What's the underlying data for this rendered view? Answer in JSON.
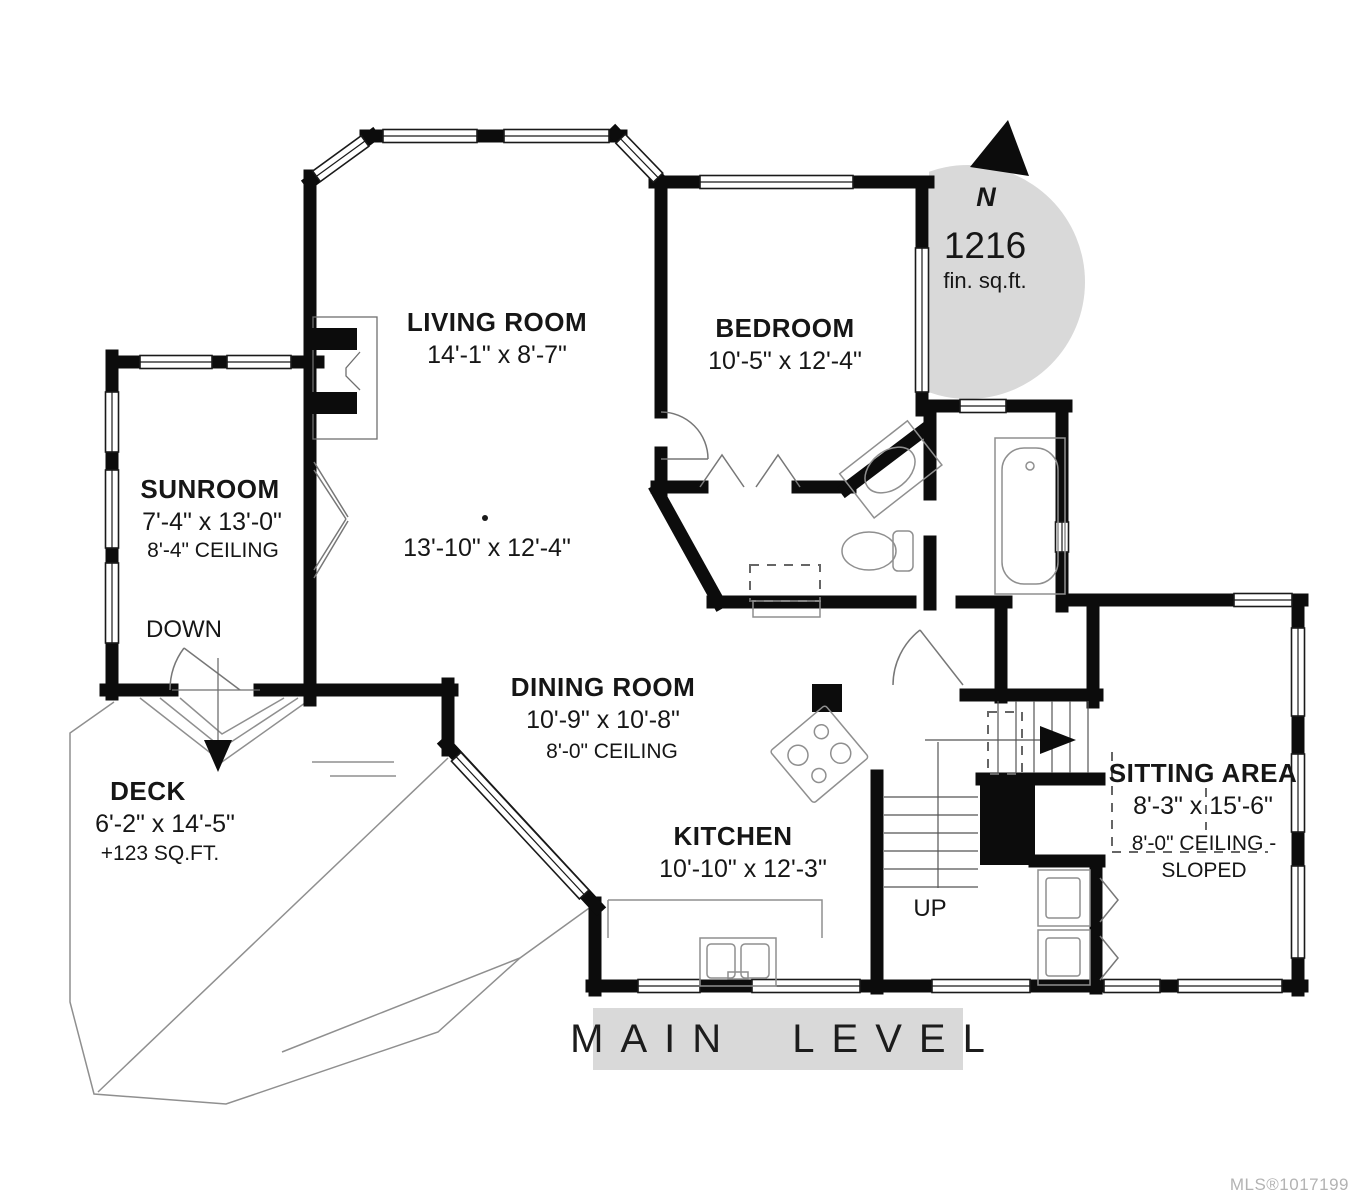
{
  "banner": {
    "label": "MAIN LEVEL"
  },
  "footer": {
    "mls": "MLS®1017199"
  },
  "compass": {
    "north_label": "N",
    "area_value": "1216",
    "area_unit": "fin. sq.ft."
  },
  "rooms": {
    "living_room": {
      "name": "LIVING ROOM",
      "dims": "14'-1\" x 8'-7\""
    },
    "living_room_lower": {
      "dims": "13'-10\" x 12'-4\""
    },
    "bedroom": {
      "name": "BEDROOM",
      "dims": "10'-5\" x 12'-4\""
    },
    "sunroom": {
      "name": "SUNROOM",
      "dims": "7'-4\" x 13'-0\"",
      "ceiling": "8'-4\" CEILING"
    },
    "dining_room": {
      "name": "DINING ROOM",
      "dims": "10'-9\" x 10'-8\"",
      "ceiling": "8'-0\" CEILING"
    },
    "kitchen": {
      "name": "KITCHEN",
      "dims": "10'-10\" x 12'-3\""
    },
    "sitting_area": {
      "name": "SITTING AREA",
      "dims": "8'-3\" x 15'-6\"",
      "ceiling_line1": "8'-0\" CEILING -",
      "ceiling_line2": "SLOPED"
    },
    "deck": {
      "name": "DECK",
      "dims": "6'-2\" x 14'-5\"",
      "extra": "+123 SQ.FT."
    }
  },
  "stairs": {
    "up_label": "UP",
    "down_label": "DOWN"
  },
  "colors": {
    "wall": "#0c0c0c",
    "shade": "#d9d9d9",
    "mls_text": "#b3b3b3",
    "thin_line": "#8f8f8f"
  }
}
